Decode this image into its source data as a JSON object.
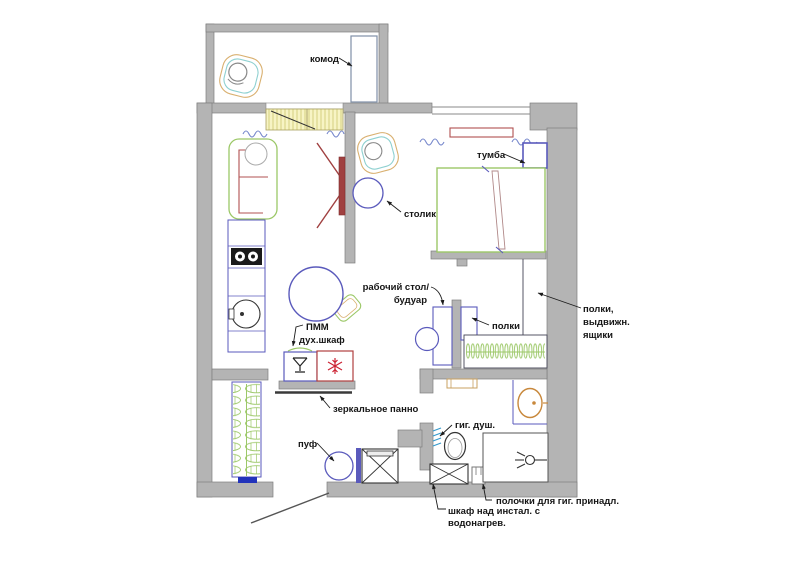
{
  "meta": {
    "type": "apartment-floor-plan",
    "language": "ru"
  },
  "labels": {
    "komod": "комод",
    "tumba": "тумба",
    "stolik": "столик",
    "desk1": "рабочий стол/",
    "desk2": "будуар",
    "polki": "полки",
    "shelves1": "полки,",
    "shelves2": "выдвижн.",
    "shelves3": "ящики",
    "pmm1": "ПММ",
    "pmm2": "дух.шкаф",
    "mirror": "зеркальное панно",
    "puf": "пуф",
    "gig": "гиг. душ.",
    "polochki": "полочки для гиг. принадл.",
    "shkaf1": "шкаф над инстал. с",
    "shkaf2": "водонагрев."
  },
  "colors": {
    "wall": "#b4b4b4",
    "wall_edge": "#7e7e7e",
    "furniture_blue": "#5a5abc",
    "soft_green": "#9cc868",
    "accent_red": "#b05050",
    "snowflake_red": "#cc2233",
    "fixture_orange": "#c8883c",
    "teal": "#8ed0d0",
    "window_yellow": "#f7f4c4",
    "hatch_blue": "#3399cc",
    "label_text": "#151515"
  }
}
